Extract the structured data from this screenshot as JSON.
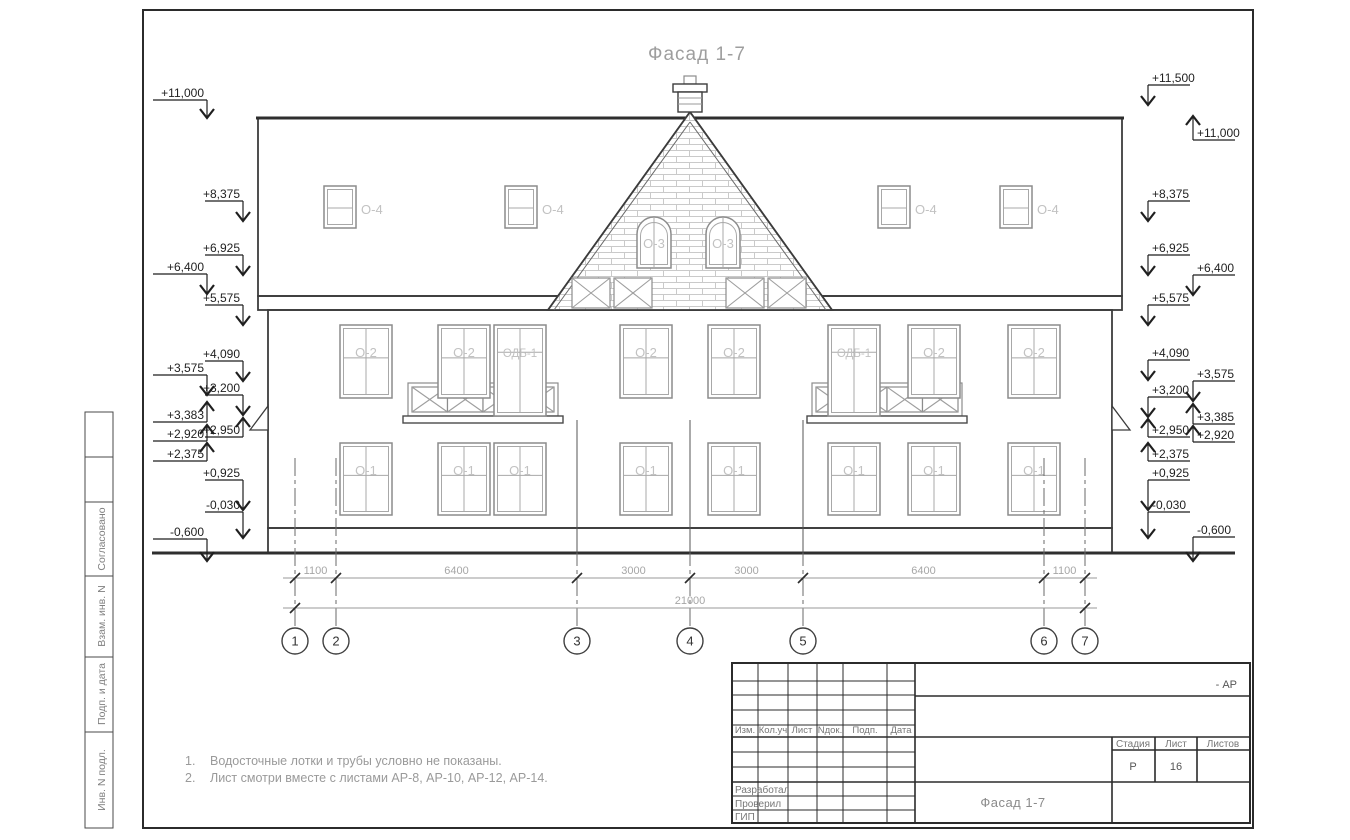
{
  "sheet": {
    "title": "Фасад 1-7",
    "notes": [
      {
        "num": "1.",
        "text": "Водосточные лотки и трубы условно не показаны."
      },
      {
        "num": "2.",
        "text": "Лист смотри вместе с листами АР-8, АР-10, АР-12, АР-14."
      }
    ],
    "side_labels": [
      "Согласовано",
      "Взам. инв. N",
      "Подп. и дата",
      "Инв. N подл."
    ]
  },
  "title_block": {
    "revision_columns": [
      "Изм.",
      "Кол.уч",
      "Лист",
      "Nдок.",
      "Подп.",
      "Дата"
    ],
    "signature_rows": [
      "Разработал",
      "Проверил",
      "ГИП"
    ],
    "stage_columns": [
      "Стадия",
      "Лист",
      "Листов"
    ],
    "stage_value": "Р",
    "sheet_value": "16",
    "sheets_total_value": "",
    "doc_code": "- АР",
    "doc_title": "Фасад 1-7"
  },
  "axes": {
    "numbers": [
      "1",
      "2",
      "3",
      "4",
      "5",
      "6",
      "7"
    ],
    "x": [
      295,
      336,
      577,
      690,
      803,
      1044,
      1085
    ]
  },
  "dimensions": {
    "segments": [
      "1100",
      "6400",
      "3000",
      "3000",
      "6400",
      "1100"
    ],
    "total": "21000"
  },
  "windows": {
    "dormer_label": "О-4",
    "gable_label": "О-3",
    "floor2_labels": [
      "О-2",
      "О-2",
      "ОДБ-1",
      "О-2",
      "О-2",
      "ОДБ-1",
      "О-2",
      "О-2"
    ],
    "floor1_labels": [
      "О-1",
      "О-1",
      "О-1",
      "О-1",
      "О-1",
      "О-1",
      "О-1",
      "О-1"
    ]
  },
  "elevations": {
    "left": [
      {
        "label": "+11,000",
        "col": "outer",
        "y": 100,
        "dir": "down",
        "len": 18
      },
      {
        "label": "+8,375",
        "col": "inner",
        "y": 201,
        "dir": "down",
        "len": 20
      },
      {
        "label": "+6,925",
        "col": "inner",
        "y": 255,
        "dir": "down",
        "len": 20
      },
      {
        "label": "+6,400",
        "col": "outer",
        "y": 274,
        "dir": "down",
        "len": 20
      },
      {
        "label": "+5,575",
        "col": "inner",
        "y": 305,
        "dir": "down",
        "len": 20
      },
      {
        "label": "+4,090",
        "col": "inner",
        "y": 361,
        "dir": "down",
        "len": 20
      },
      {
        "label": "+3,575",
        "col": "outer",
        "y": 375,
        "dir": "down",
        "len": 20
      },
      {
        "label": "+3,200",
        "col": "inner",
        "y": 395,
        "dir": "down",
        "len": 20
      },
      {
        "label": "+3,383",
        "col": "outer",
        "y": 422,
        "dir": "up",
        "len": 20
      },
      {
        "label": "+2,950",
        "col": "inner",
        "y": 437,
        "dir": "up",
        "len": 19
      },
      {
        "label": "+2,920",
        "col": "outer",
        "y": 441,
        "dir": "up",
        "len": 16
      },
      {
        "label": "+2,375",
        "col": "outer",
        "y": 461,
        "dir": "up",
        "len": 18
      },
      {
        "label": "+0,925",
        "col": "inner",
        "y": 480,
        "dir": "down",
        "len": 30
      },
      {
        "label": "-0,030",
        "col": "inner",
        "y": 512,
        "dir": "down",
        "len": 26
      },
      {
        "label": "-0,600",
        "col": "outer",
        "y": 539,
        "dir": "down",
        "len": 22
      }
    ],
    "right": [
      {
        "label": "+11,500",
        "col": "inner",
        "y": 85,
        "dir": "down",
        "len": 20
      },
      {
        "label": "+11,000",
        "col": "outer",
        "y": 140,
        "dir": "up",
        "len": 24
      },
      {
        "label": "+8,375",
        "col": "inner",
        "y": 201,
        "dir": "down",
        "len": 20
      },
      {
        "label": "+6,925",
        "col": "inner",
        "y": 255,
        "dir": "down",
        "len": 20
      },
      {
        "label": "+6,400",
        "col": "outer",
        "y": 275,
        "dir": "down",
        "len": 20
      },
      {
        "label": "+5,575",
        "col": "inner",
        "y": 305,
        "dir": "down",
        "len": 20
      },
      {
        "label": "+4,090",
        "col": "inner",
        "y": 360,
        "dir": "down",
        "len": 20
      },
      {
        "label": "+3,575",
        "col": "outer",
        "y": 381,
        "dir": "down",
        "len": 20
      },
      {
        "label": "+3,200",
        "col": "inner",
        "y": 397,
        "dir": "down",
        "len": 20
      },
      {
        "label": "+3,385",
        "col": "outer",
        "y": 424,
        "dir": "up",
        "len": 20
      },
      {
        "label": "+2,950",
        "col": "inner",
        "y": 437,
        "dir": "up",
        "len": 18
      },
      {
        "label": "+2,920",
        "col": "outer",
        "y": 442,
        "dir": "up",
        "len": 16
      },
      {
        "label": "+2,375",
        "col": "inner",
        "y": 461,
        "dir": "up",
        "len": 18
      },
      {
        "label": "+0,925",
        "col": "inner",
        "y": 480,
        "dir": "down",
        "len": 30
      },
      {
        "label": "-0,030",
        "col": "inner",
        "y": 512,
        "dir": "down",
        "len": 26
      },
      {
        "label": "-0,600",
        "col": "outer",
        "y": 537,
        "dir": "down",
        "len": 24
      }
    ]
  }
}
